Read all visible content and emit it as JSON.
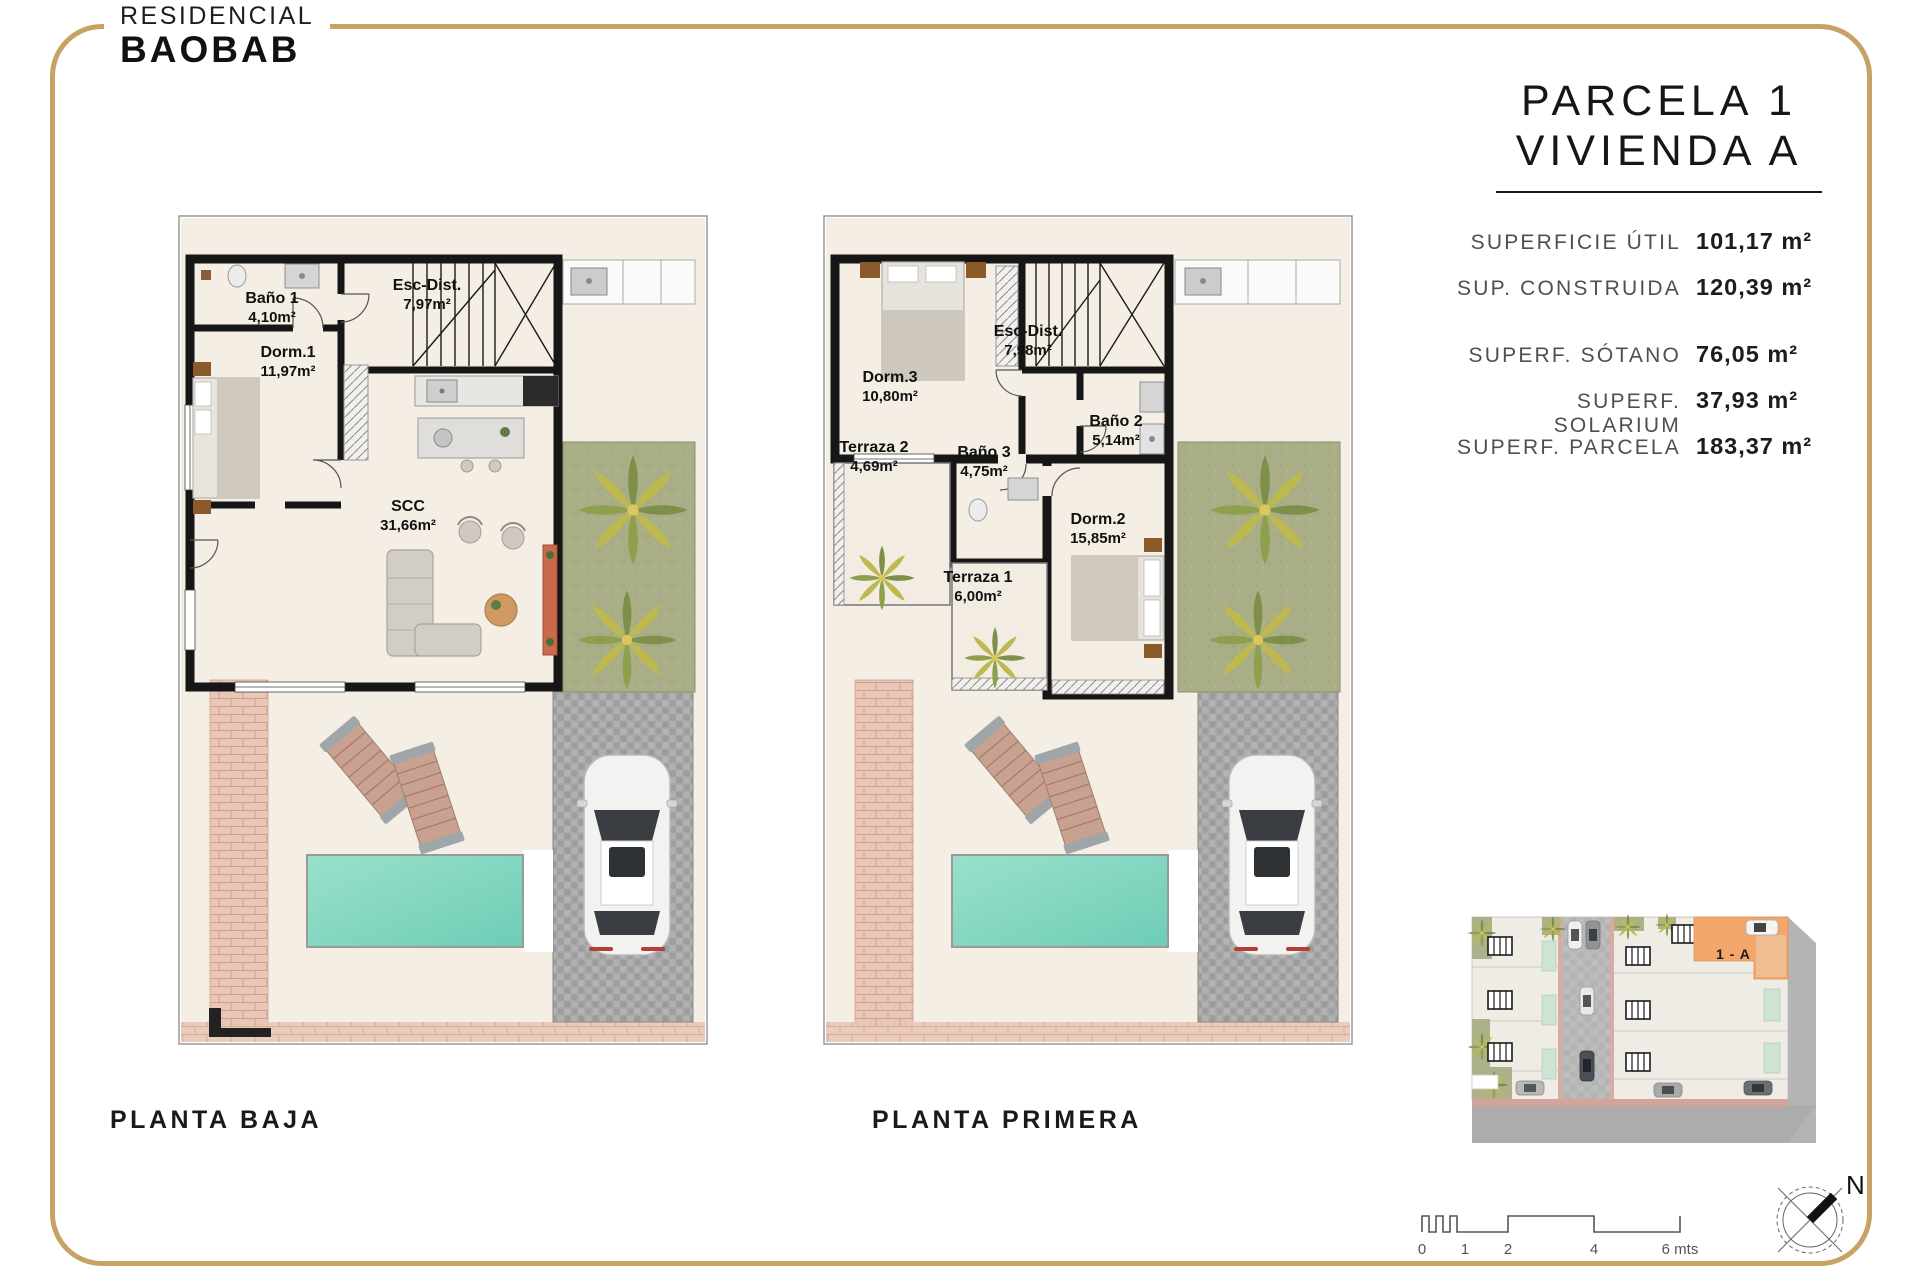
{
  "brand": {
    "line1": "RESIDENCIAL",
    "line2": "BAOBAB"
  },
  "title": {
    "line1": "PARCELA 1",
    "line2": "VIVIENDA A"
  },
  "specs": {
    "group1": [
      {
        "label": "SUPERFICIE ÚTIL",
        "value": "101,17 m²"
      },
      {
        "label": "SUP. CONSTRUIDA",
        "value": "120,39 m²"
      }
    ],
    "group2": [
      {
        "label": "SUPERF. SÓTANO",
        "value": "76,05 m²"
      },
      {
        "label": "SUPERF. SOLARIUM",
        "value": "37,93 m²"
      },
      {
        "label": "SUPERF. PARCELA",
        "value": "183,37 m²"
      }
    ]
  },
  "plans": {
    "ground": {
      "caption": "PLANTA BAJA",
      "rooms": [
        {
          "name": "Baño 1",
          "area": "4,10m²"
        },
        {
          "name": "Esc-Dist.",
          "area": "7,97m²"
        },
        {
          "name": "Dorm.1",
          "area": "11,97m²"
        },
        {
          "name": "SCC",
          "area": "31,66m²"
        }
      ]
    },
    "first": {
      "caption": "PLANTA PRIMERA",
      "rooms": [
        {
          "name": "Dorm.3",
          "area": "10,80m²"
        },
        {
          "name": "Esc-Dist.",
          "area": "7,98m²"
        },
        {
          "name": "Baño 2",
          "area": "5,14m²"
        },
        {
          "name": "Terraza 2",
          "area": "4,69m²"
        },
        {
          "name": "Baño 3",
          "area": "4,75m²"
        },
        {
          "name": "Dorm.2",
          "area": "15,85m²"
        },
        {
          "name": "Terraza 1",
          "area": "6,00m²"
        }
      ]
    }
  },
  "siteplan": {
    "unit_label": "1 - A"
  },
  "scalebar": {
    "ticks": [
      "0",
      "1",
      "2",
      "4",
      "6 mts"
    ]
  },
  "compass": {
    "north": "N"
  },
  "colors": {
    "gold": "#c8a264",
    "pool": "#7fd4be",
    "garden": "#a9ae87",
    "highlight": "#f4a76d"
  }
}
